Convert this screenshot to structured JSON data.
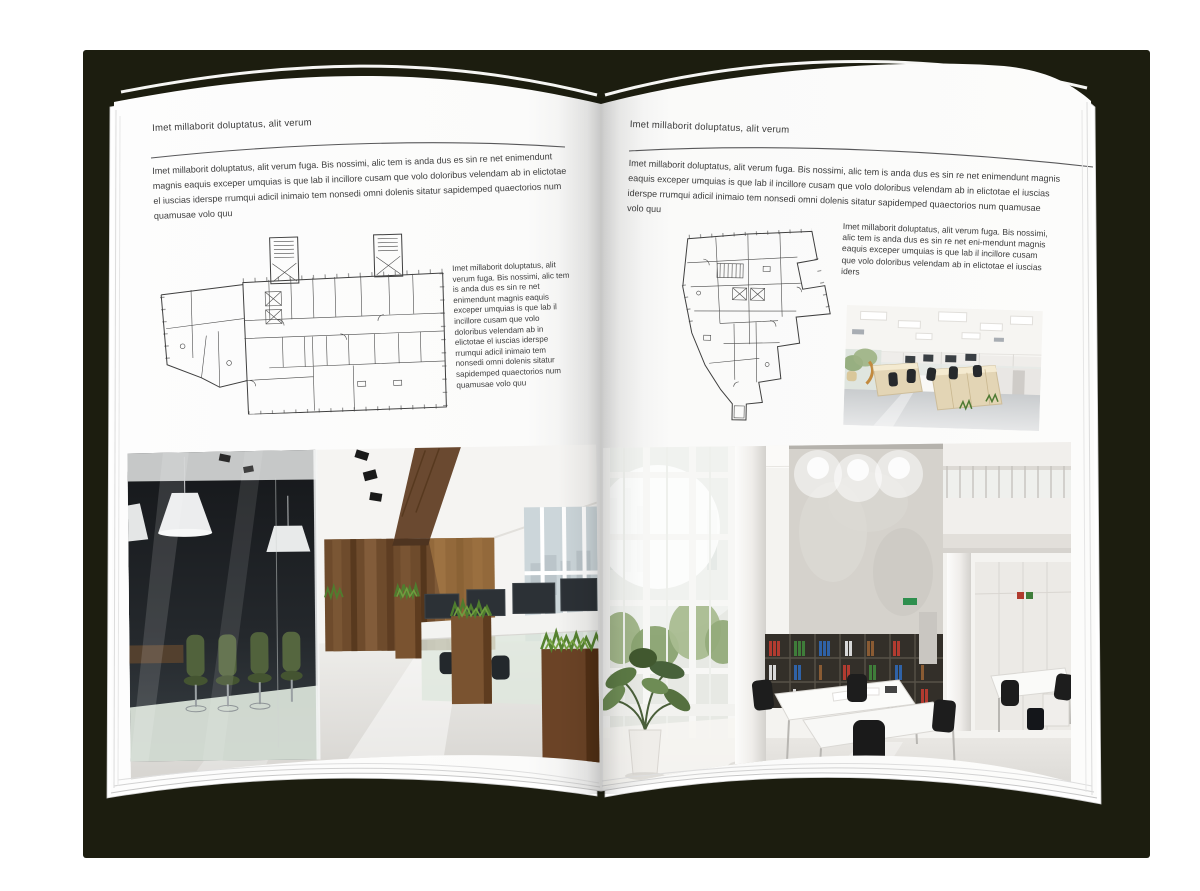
{
  "palette": {
    "backdrop": "#1c1d0f",
    "page": "#fdfdfd",
    "text": "#3c3c3c",
    "wood": "#6e4b2c",
    "plant_green": "#4f7d2e",
    "binder_red": "#b23b30",
    "binder_green": "#3f7d3a",
    "binder_blue": "#2f62a7"
  },
  "book": {
    "left": {
      "header": "Imet millaborit doluptatus, alit verum",
      "intro": "Imet millaborit doluptatus, alit verum fuga. Bis nossimi, alic tem is anda dus es sin re net enimendunt magnis eaquis exceper umquias is que lab il incillore cusam que volo doloribus velendam ab in elictotae el iuscias iderspe rrumqui adicil inimaio tem nonsedi omni dolenis sitatur sapidemped quaectorios num quamusae volo quu",
      "side_text": "Imet millaborit doluptatus, alit verum fuga. Bis nossimi, alic tem is anda dus es sin re net enimendunt magnis eaquis exceper umquias is que lab il incillore cusam que volo doloribus velendam ab in elictotae el iuscias iderspe rrumqui adicil inimaio tem nonsedi omni dolenis sitatur sapidemped quaectorios num quamusae volo quu",
      "floor_plan_name": "floor-plan-rectangular-building",
      "photo_name": "dark-office-glass-meeting-room-photo"
    },
    "right": {
      "header": "Imet millaborit doluptatus, alit verum",
      "intro": "Imet millaborit doluptatus, alit verum fuga. Bis nossimi, alic tem is anda dus es sin re net enimendunt magnis eaquis exceper umquias is que lab il incillore cusam que volo doloribus velendam ab in elictotae el iuscias iderspe rrumqui adicil inimaio tem nonsedi omni dolenis sitatur sapidemped quaectorios num quamusae volo quu",
      "side_text": "Imet millaborit doluptatus, alit verum fuga. Bis nossimi, alic tem is anda dus es sin re net eni-mendunt magnis eaquis exceper umquias is que lab il incillore cusam que volo doloribus velendam ab in elictotae el iuscias iders",
      "floor_plan_name": "floor-plan-irregular-building",
      "photo_small_name": "bright-open-office-desks-photo",
      "photo_large_name": "double-height-office-bookshelf-photo"
    }
  }
}
